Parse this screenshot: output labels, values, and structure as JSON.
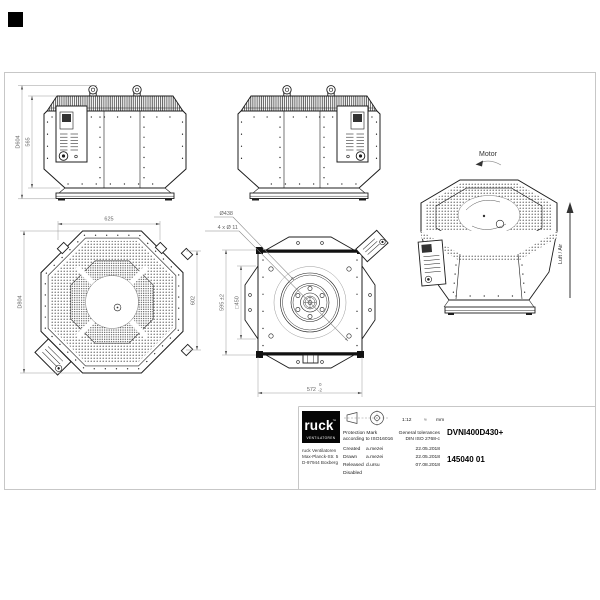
{
  "sheet": {
    "background": "#ffffff",
    "line_color": "#1c1c1c",
    "dimension_color": "#666666",
    "frame_color": "#c7c7c7"
  },
  "views": {
    "side_front": {
      "dim_total_height": "D604",
      "dim_body_height": "565"
    },
    "isometric": {
      "motor_label": "Motor",
      "airflow_label": "Luft / Air"
    },
    "top": {
      "dim_width": "625",
      "dim_diameter": "D804",
      "dim_side": "602"
    },
    "bottom": {
      "label_inlet_diameter": "Ø438",
      "label_mounting_holes": "4 x Ø 11",
      "dim_height": "595 ±2",
      "dim_inner_square": "□450",
      "dim_width": "572",
      "dim_width_tol_upper": "0",
      "dim_width_tol_lower": "-2"
    }
  },
  "title_block": {
    "logo_brand": "ruck",
    "logo_tm": "™",
    "logo_subtitle": "VENTILATOREN",
    "address_line1": "ruck Ventilatoren",
    "address_line2": "Max-Planck-Str. 5",
    "address_line3": "D-97944 Boxberg",
    "scale": "1:12",
    "mass_symbol": "≈",
    "unit": "mm",
    "protection_line1": "Protection Mark",
    "protection_line2": "according to ISO16016",
    "tolerance_line1": "General tolerances",
    "tolerance_line2": "DIN ISO 2768-c",
    "rows": [
      {
        "label": "Created",
        "name": "a.mezei",
        "date": "22.05.2018"
      },
      {
        "label": "Drawn",
        "name": "a.mezei",
        "date": "22.05.2018"
      },
      {
        "label": "Released",
        "name": "d.ursu",
        "date": "07.08.2018"
      },
      {
        "label": "Disabled",
        "name": "",
        "date": ""
      }
    ],
    "part_number": "DVNI400D430+",
    "document_number": "145040 01"
  }
}
